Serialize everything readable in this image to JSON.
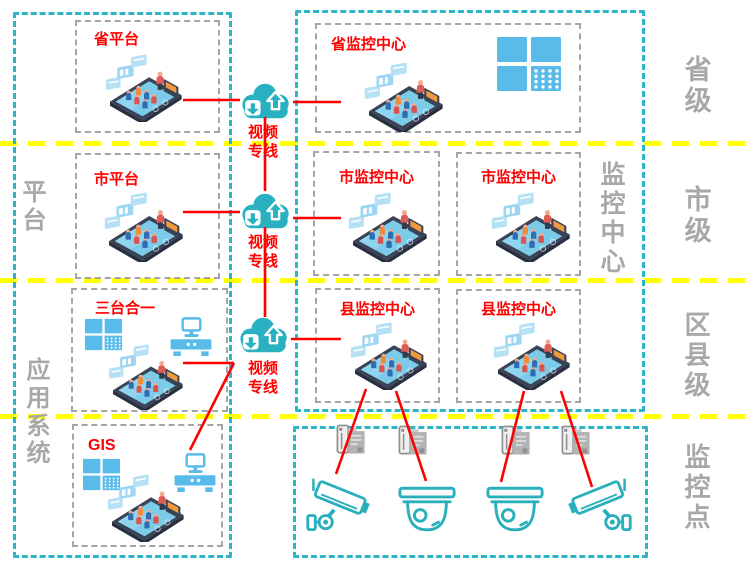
{
  "colors": {
    "frame_teal": "#2cb5c6",
    "divider_yellow": "#ffff00",
    "line_red": "#fe0000",
    "label_gray": "#a8a8a8",
    "box_border_gray": "#a5a5a5",
    "icon_blue": "#58bbea",
    "camera_teal": "#2aafbd"
  },
  "left_panel": {
    "side_labels": [
      {
        "text": "平台"
      },
      {
        "text": "应用系统"
      }
    ],
    "boxes": [
      {
        "title": "省平台",
        "icons": [
          "meeting-room-phone-icon"
        ]
      },
      {
        "title": "市平台",
        "icons": [
          "meeting-room-phone-icon"
        ]
      },
      {
        "title": "三台合一",
        "icons": [
          "video-wall-icon",
          "workstation-desk-icon",
          "meeting-room-phone-icon"
        ]
      },
      {
        "title": "GIS",
        "icons": [
          "video-wall-icon",
          "workstation-desk-icon",
          "meeting-room-phone-icon"
        ]
      }
    ]
  },
  "center": {
    "clouds": [
      {
        "icon": "cloud-sync-icon",
        "label": "视频专线"
      },
      {
        "icon": "cloud-sync-icon",
        "label": "视频专线"
      },
      {
        "icon": "cloud-sync-icon",
        "label": "视频专线"
      }
    ]
  },
  "right_panel": {
    "side_label": "监控中心",
    "boxes": [
      {
        "title": "省监控中心",
        "icons": [
          "meeting-room-phone-icon",
          "video-wall-icon"
        ]
      },
      {
        "title": "市监控中心",
        "icons": [
          "meeting-room-phone-icon"
        ]
      },
      {
        "title": "市监控中心",
        "icons": [
          "meeting-room-phone-icon"
        ]
      },
      {
        "title": "县监控中心",
        "icons": [
          "meeting-room-phone-icon"
        ]
      },
      {
        "title": "县监控中心",
        "icons": [
          "meeting-room-phone-icon"
        ]
      }
    ]
  },
  "monitoring_points": {
    "devices": [
      "nvr-icon",
      "nvr-icon",
      "nvr-icon",
      "nvr-icon"
    ],
    "cameras": [
      "bullet-camera-icon",
      "dome-camera-icon",
      "dome-camera-icon",
      "bullet-camera-icon"
    ]
  },
  "levels": [
    {
      "text": "省级"
    },
    {
      "text": "市级"
    },
    {
      "text": "区县级"
    },
    {
      "text": "监控点"
    }
  ]
}
